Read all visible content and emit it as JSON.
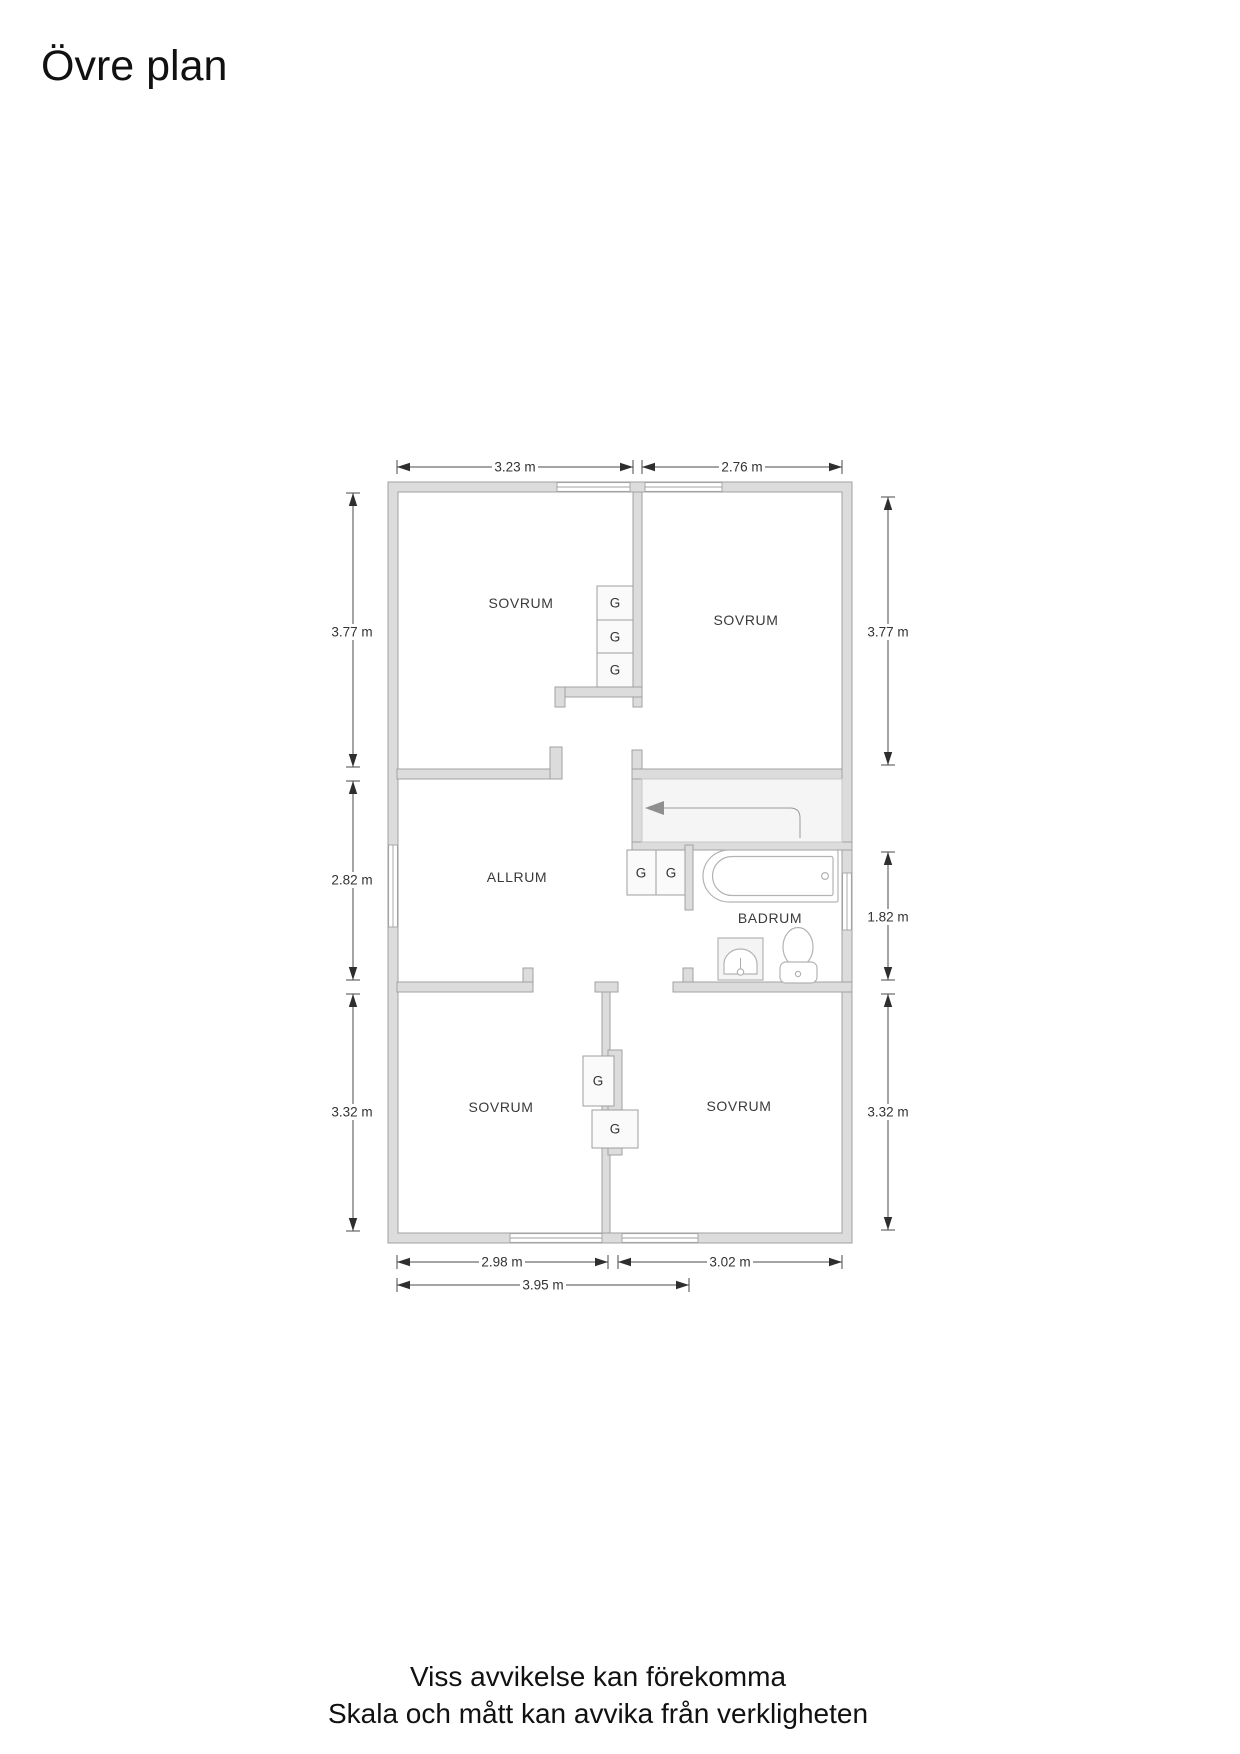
{
  "title": "Övre plan",
  "footer": {
    "line1": "Viss avvikelse kan förekomma",
    "line2": "Skala och mått kan avvika från verkligheten"
  },
  "rooms": {
    "sovrum_top_left": "SOVRUM",
    "sovrum_top_right": "SOVRUM",
    "allrum": "ALLRUM",
    "badrum": "BADRUM",
    "sovrum_bottom_left": "SOVRUM",
    "sovrum_bottom_right": "SOVRUM"
  },
  "wardrobes": [
    {
      "label": "G",
      "location": "top-left-bedroom-closet-1"
    },
    {
      "label": "G",
      "location": "top-left-bedroom-closet-2"
    },
    {
      "label": "G",
      "location": "top-left-bedroom-closet-3"
    },
    {
      "label": "G",
      "location": "hall-closet-1"
    },
    {
      "label": "G",
      "location": "hall-closet-2"
    },
    {
      "label": "G",
      "location": "bottom-bedrooms-closet-1"
    },
    {
      "label": "G",
      "location": "bottom-bedrooms-closet-2"
    }
  ],
  "dimensions": {
    "top": [
      "3.23 m",
      "2.76 m"
    ],
    "left": [
      "3.77 m",
      "2.82 m",
      "3.32 m"
    ],
    "right": [
      "3.77 m",
      "1.82 m",
      "3.32 m"
    ],
    "bottom": [
      "2.98 m",
      "3.02 m"
    ],
    "bottom_total": "3.95 m"
  },
  "colors": {
    "wall_fill": "#dcdcdc",
    "wall_stroke": "#a2a2a2",
    "dimension_text": "#333333"
  }
}
